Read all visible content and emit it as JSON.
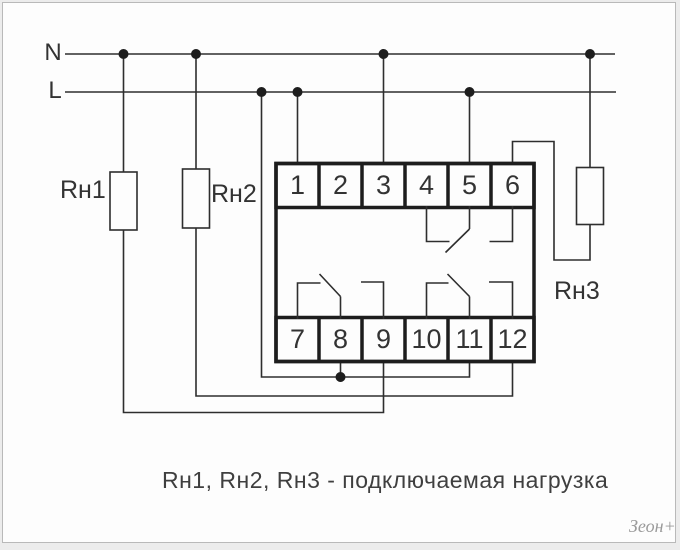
{
  "diagram": {
    "power_lines": {
      "neutral": "N",
      "phase": "L"
    },
    "loads": {
      "rn1": "Rн1",
      "rn2": "Rн2",
      "rn3": "Rн3"
    },
    "relay_block": {
      "top_terminals": [
        "1",
        "2",
        "3",
        "4",
        "5",
        "6"
      ],
      "bottom_terminals": [
        "7",
        "8",
        "9",
        "10",
        "11",
        "12"
      ]
    },
    "caption": "Rн1, Rн2, Rн3 - подключаемая нагрузка",
    "watermark": "Зеон+"
  },
  "colors": {
    "wire": "#2e2e2e",
    "thick": "#1d1d1d",
    "text": "#333333",
    "captext": "#3f3f3f",
    "bg": "#fdfdfd",
    "frame": "#b9b9b9",
    "outer": "#ececec",
    "wm": "#9b9b9b"
  }
}
